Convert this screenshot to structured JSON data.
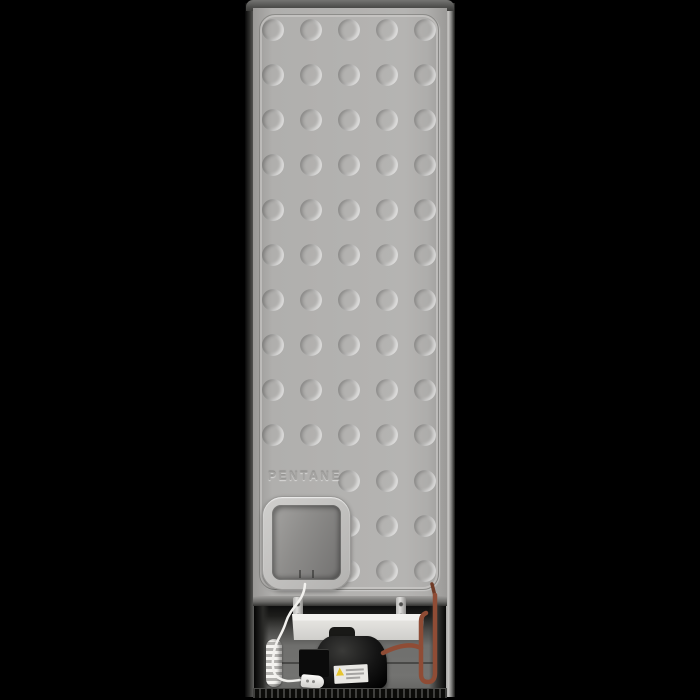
{
  "scene": {
    "description": "Rear view of a freestanding refrigerator, studio product photo",
    "background_color": "#000000"
  },
  "panel": {
    "embossed_text": "PENTANE",
    "base_color": "#b2b1af",
    "dimple_grid": {
      "diameter": 22,
      "col_centers": [
        28,
        66,
        104,
        142,
        180
      ],
      "full_row_centers": [
        30,
        75,
        120,
        165,
        210,
        255,
        300,
        345,
        390,
        435
      ],
      "partial_row_centers": [
        481,
        526,
        571
      ],
      "partial_row_cols": [
        104,
        142,
        180
      ]
    }
  },
  "access_panel": {
    "frame_color": "#c4c3c1",
    "recess_color": "#8d8c8a"
  },
  "bottom_unit": {
    "tray_color": "#e2e1dd",
    "compressor_color": "#131313",
    "pipe_color": "#8f4c35",
    "pipe_dark_color": "#6f3a26",
    "cable_color": "#f2f1ee",
    "warning_label": {
      "bg_color": "#e9e8e4",
      "triangle_color": "#e6c52e"
    }
  }
}
